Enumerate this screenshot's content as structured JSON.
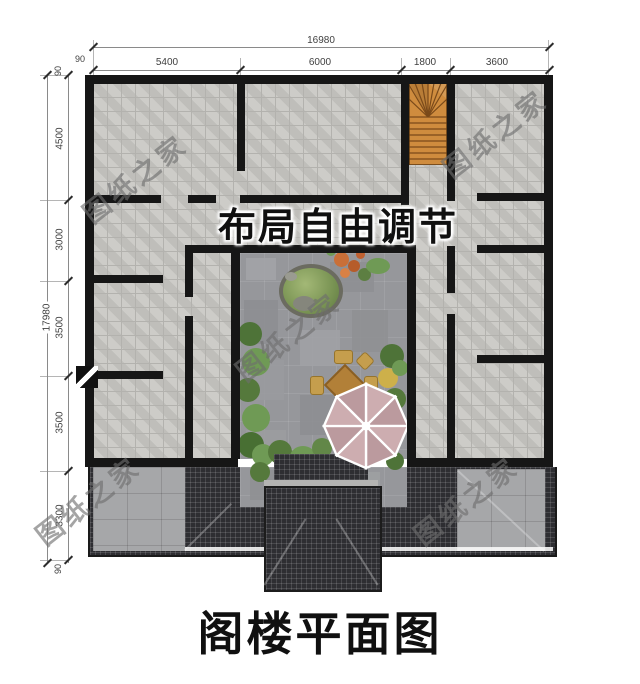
{
  "page": {
    "title": "阁楼平面图"
  },
  "plan": {
    "annotation": "布局自由调节"
  },
  "watermark": {
    "text": "图纸之家"
  },
  "dimensions": {
    "top": {
      "total": "16980",
      "edge_left": "90",
      "segments": [
        "5400",
        "6000",
        "1800",
        "3600"
      ]
    },
    "left": {
      "total": "17980",
      "segments": [
        "90",
        "4500",
        "3000",
        "3500",
        "3500",
        "3300",
        "90"
      ]
    }
  },
  "colors": {
    "wall": "#161616",
    "floor": "#c9c8c4",
    "floor_line": "#b3b2ae",
    "court": "#96979b",
    "roof": "#2e2e32",
    "terrace": "#a6a7a9",
    "wood": "#cf8c3e",
    "wood_line": "#7a4a1a",
    "umbrella": "#c7a8ab",
    "green": "#6f9a55",
    "green_dark": "#4e7338",
    "flower": "#c96f38",
    "tan": "#bf9a4a",
    "dim": "#3f3f3f",
    "ink": "#101010",
    "watermark": "#6e6e6e"
  }
}
